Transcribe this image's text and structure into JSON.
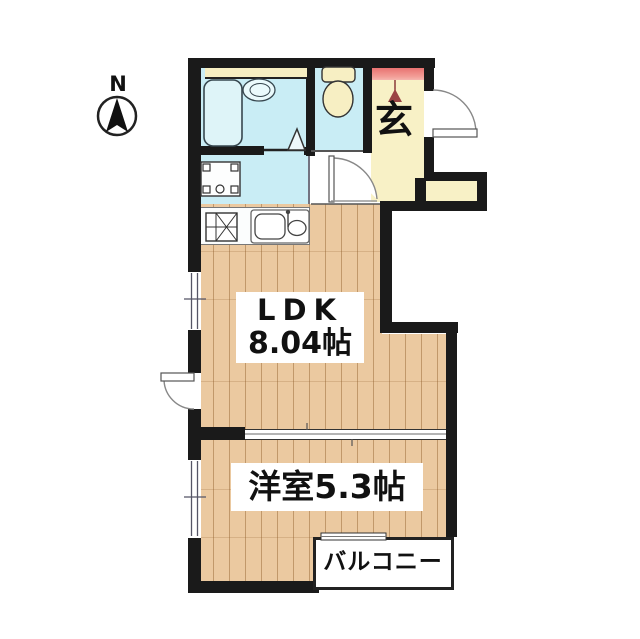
{
  "compass": {
    "north": "N"
  },
  "rooms": {
    "entrance_label": "玄",
    "ldk_name": "LDK",
    "ldk_size": "8.04帖",
    "western_room_label": "洋室5.3帖",
    "balcony_label": "バルコニー"
  },
  "colors": {
    "wall": "#1a1a1a",
    "wet_room_floor": "#c9edf5",
    "wood_floor": "#ebc9a0",
    "entrance_tile_red": "#e45f5f",
    "hall_floor_cream": "#f8f1c6",
    "fixture_cream": "#f7efc3",
    "label_background": "#ffffff"
  }
}
